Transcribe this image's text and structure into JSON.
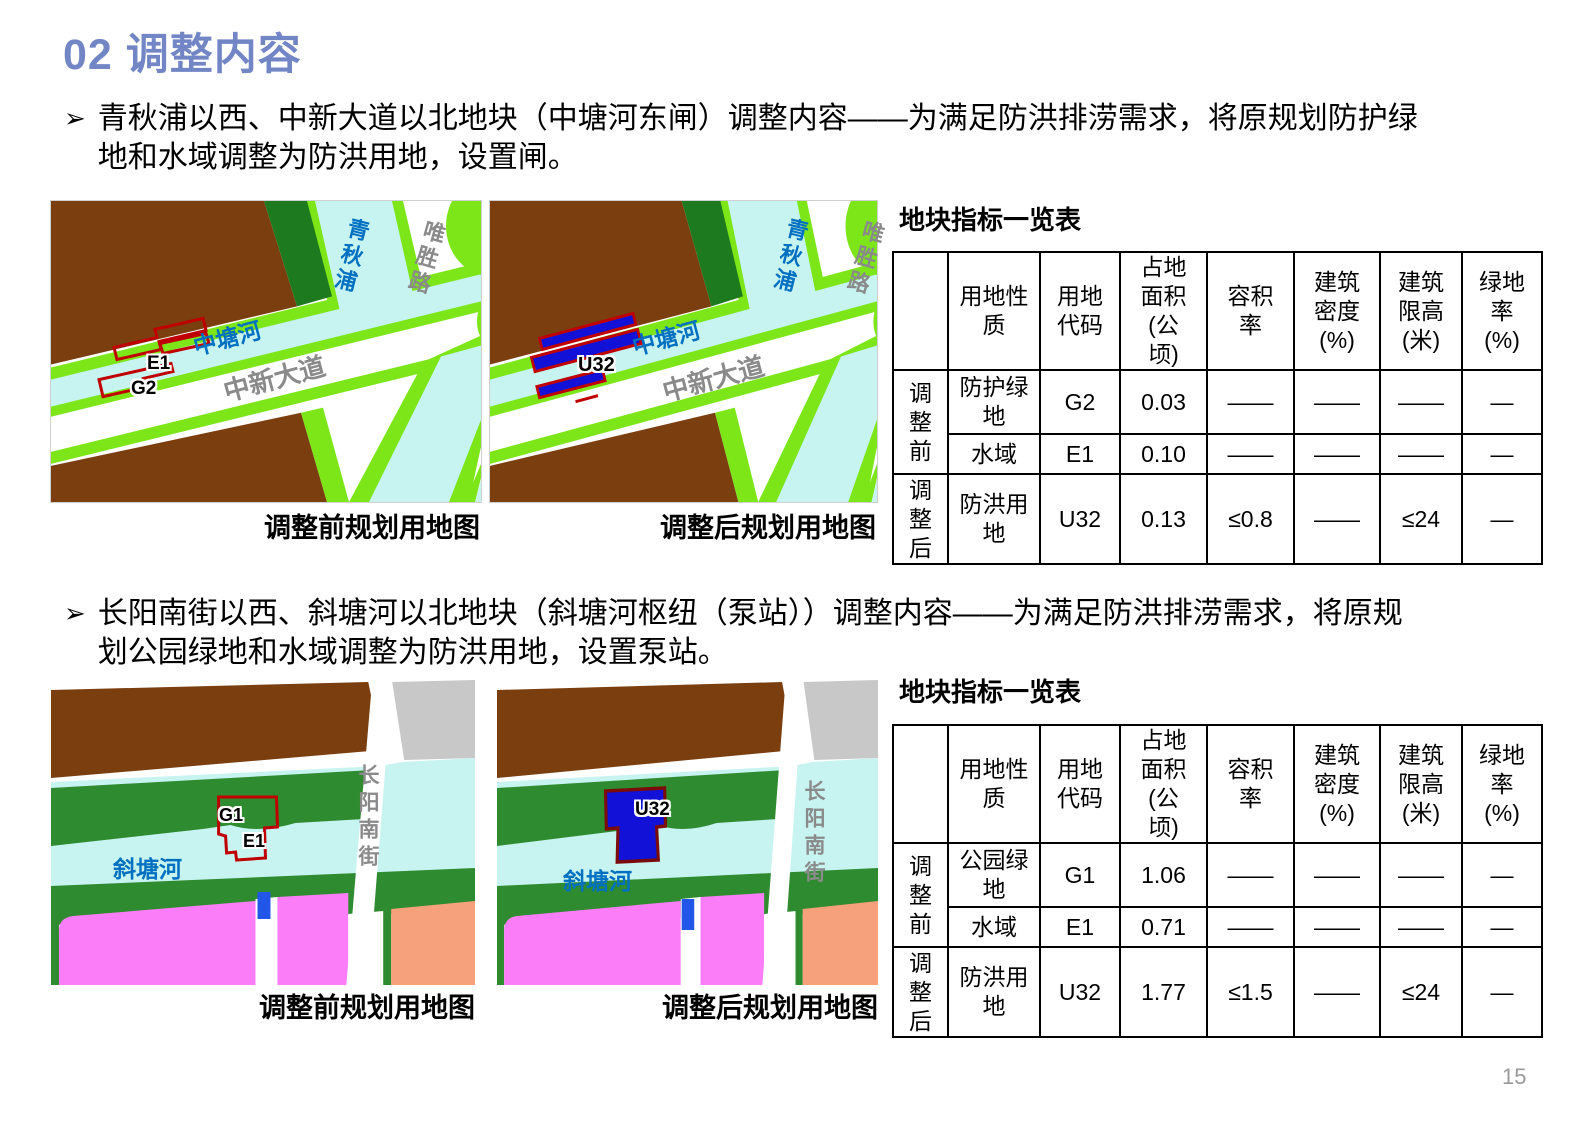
{
  "page": {
    "title": "02 调整内容",
    "page_number": "15",
    "bullet_marker": "➢"
  },
  "colors": {
    "title_accent": "#7286C5",
    "river_label_blue": "#0070C0",
    "road_label_gray": "#8A8A8A",
    "parcel_outline_red": "#C00000",
    "parcel_fill_blue": "#1111D8"
  },
  "sections": [
    {
      "bullet": "青秋浦以西、中新大道以北地块（中塘河东闸）调整内容——为满足防洪排涝需求，将原规划防护绿\n地和水域调整为防洪用地，设置闸。",
      "map_before": {
        "caption": "调整前规划用地图",
        "river_v": "青秋浦",
        "road_v": "唯胜路",
        "river_d": "中塘河",
        "road_d": "中新大道",
        "parcel_water": "E1",
        "parcel_green": "G2"
      },
      "map_after": {
        "caption": "调整后规划用地图",
        "river_v": "青秋浦",
        "road_v": "唯胜路",
        "river_d": "中塘河",
        "road_d": "中新大道",
        "parcel": "U32"
      },
      "table": {
        "title": "地块指标一览表",
        "col_headers": [
          "",
          "用地性\n质",
          "用地\n代码",
          "占地\n面积\n(公\n顷)",
          "容积\n率",
          "建筑\n密度\n(%)",
          "建筑\n限高\n(米)",
          "绿地\n率\n(%)"
        ],
        "groups": [
          {
            "label": "调\n整\n前",
            "rows": [
              [
                "防护绿\n地",
                "G2",
                "0.03",
                "——",
                "——",
                "——",
                "—"
              ],
              [
                "水域",
                "E1",
                "0.10",
                "——",
                "——",
                "——",
                "—"
              ]
            ]
          },
          {
            "label": "调\n整\n后",
            "rows": [
              [
                "防洪用\n地",
                "U32",
                "0.13",
                "≤0.8",
                "——",
                "≤24",
                "—"
              ]
            ]
          }
        ]
      }
    },
    {
      "bullet": "长阳南街以西、斜塘河以北地块（斜塘河枢纽（泵站））调整内容——为满足防洪排涝需求，将原规\n划公园绿地和水域调整为防洪用地，设置泵站。",
      "map_before": {
        "caption": "调整前规划用地图",
        "river": "斜塘河",
        "road_v": "长阳南街",
        "parcel_green": "G1",
        "parcel_water": "E1"
      },
      "map_after": {
        "caption": "调整后规划用地图",
        "river": "斜塘河",
        "road_v": "长阳南街",
        "parcel": "U32"
      },
      "table": {
        "title": "地块指标一览表",
        "col_headers": [
          "",
          "用地性\n质",
          "用地\n代码",
          "占地\n面积\n(公\n顷)",
          "容积\n率",
          "建筑\n密度\n(%)",
          "建筑\n限高\n(米)",
          "绿地\n率\n(%)"
        ],
        "groups": [
          {
            "label": "调\n整\n前",
            "rows": [
              [
                "公园绿\n地",
                "G1",
                "1.06",
                "——",
                "——",
                "——",
                "—"
              ],
              [
                "水域",
                "E1",
                "0.71",
                "——",
                "——",
                "——",
                "—"
              ]
            ]
          },
          {
            "label": "调\n整\n后",
            "rows": [
              [
                "防洪用\n地",
                "U32",
                "1.77",
                "≤1.5",
                "——",
                "≤24",
                "—"
              ]
            ]
          }
        ]
      }
    }
  ]
}
